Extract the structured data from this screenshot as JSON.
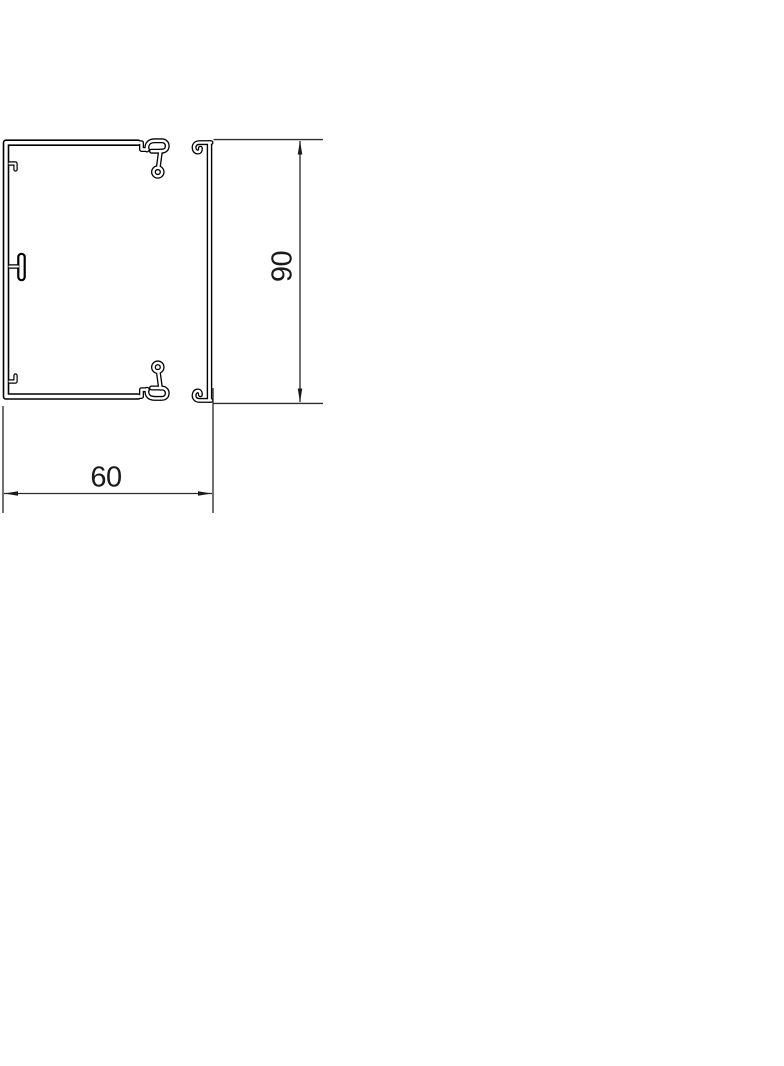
{
  "drawing": {
    "type": "technical-cross-section",
    "dimensions": {
      "height": {
        "label": "90"
      },
      "width": {
        "label": "60"
      }
    },
    "colors": {
      "background": "#ffffff",
      "profile_line": "#000000",
      "dimension_line": "#2f2f2f",
      "dimension_text": "#1a1a1a"
    }
  }
}
